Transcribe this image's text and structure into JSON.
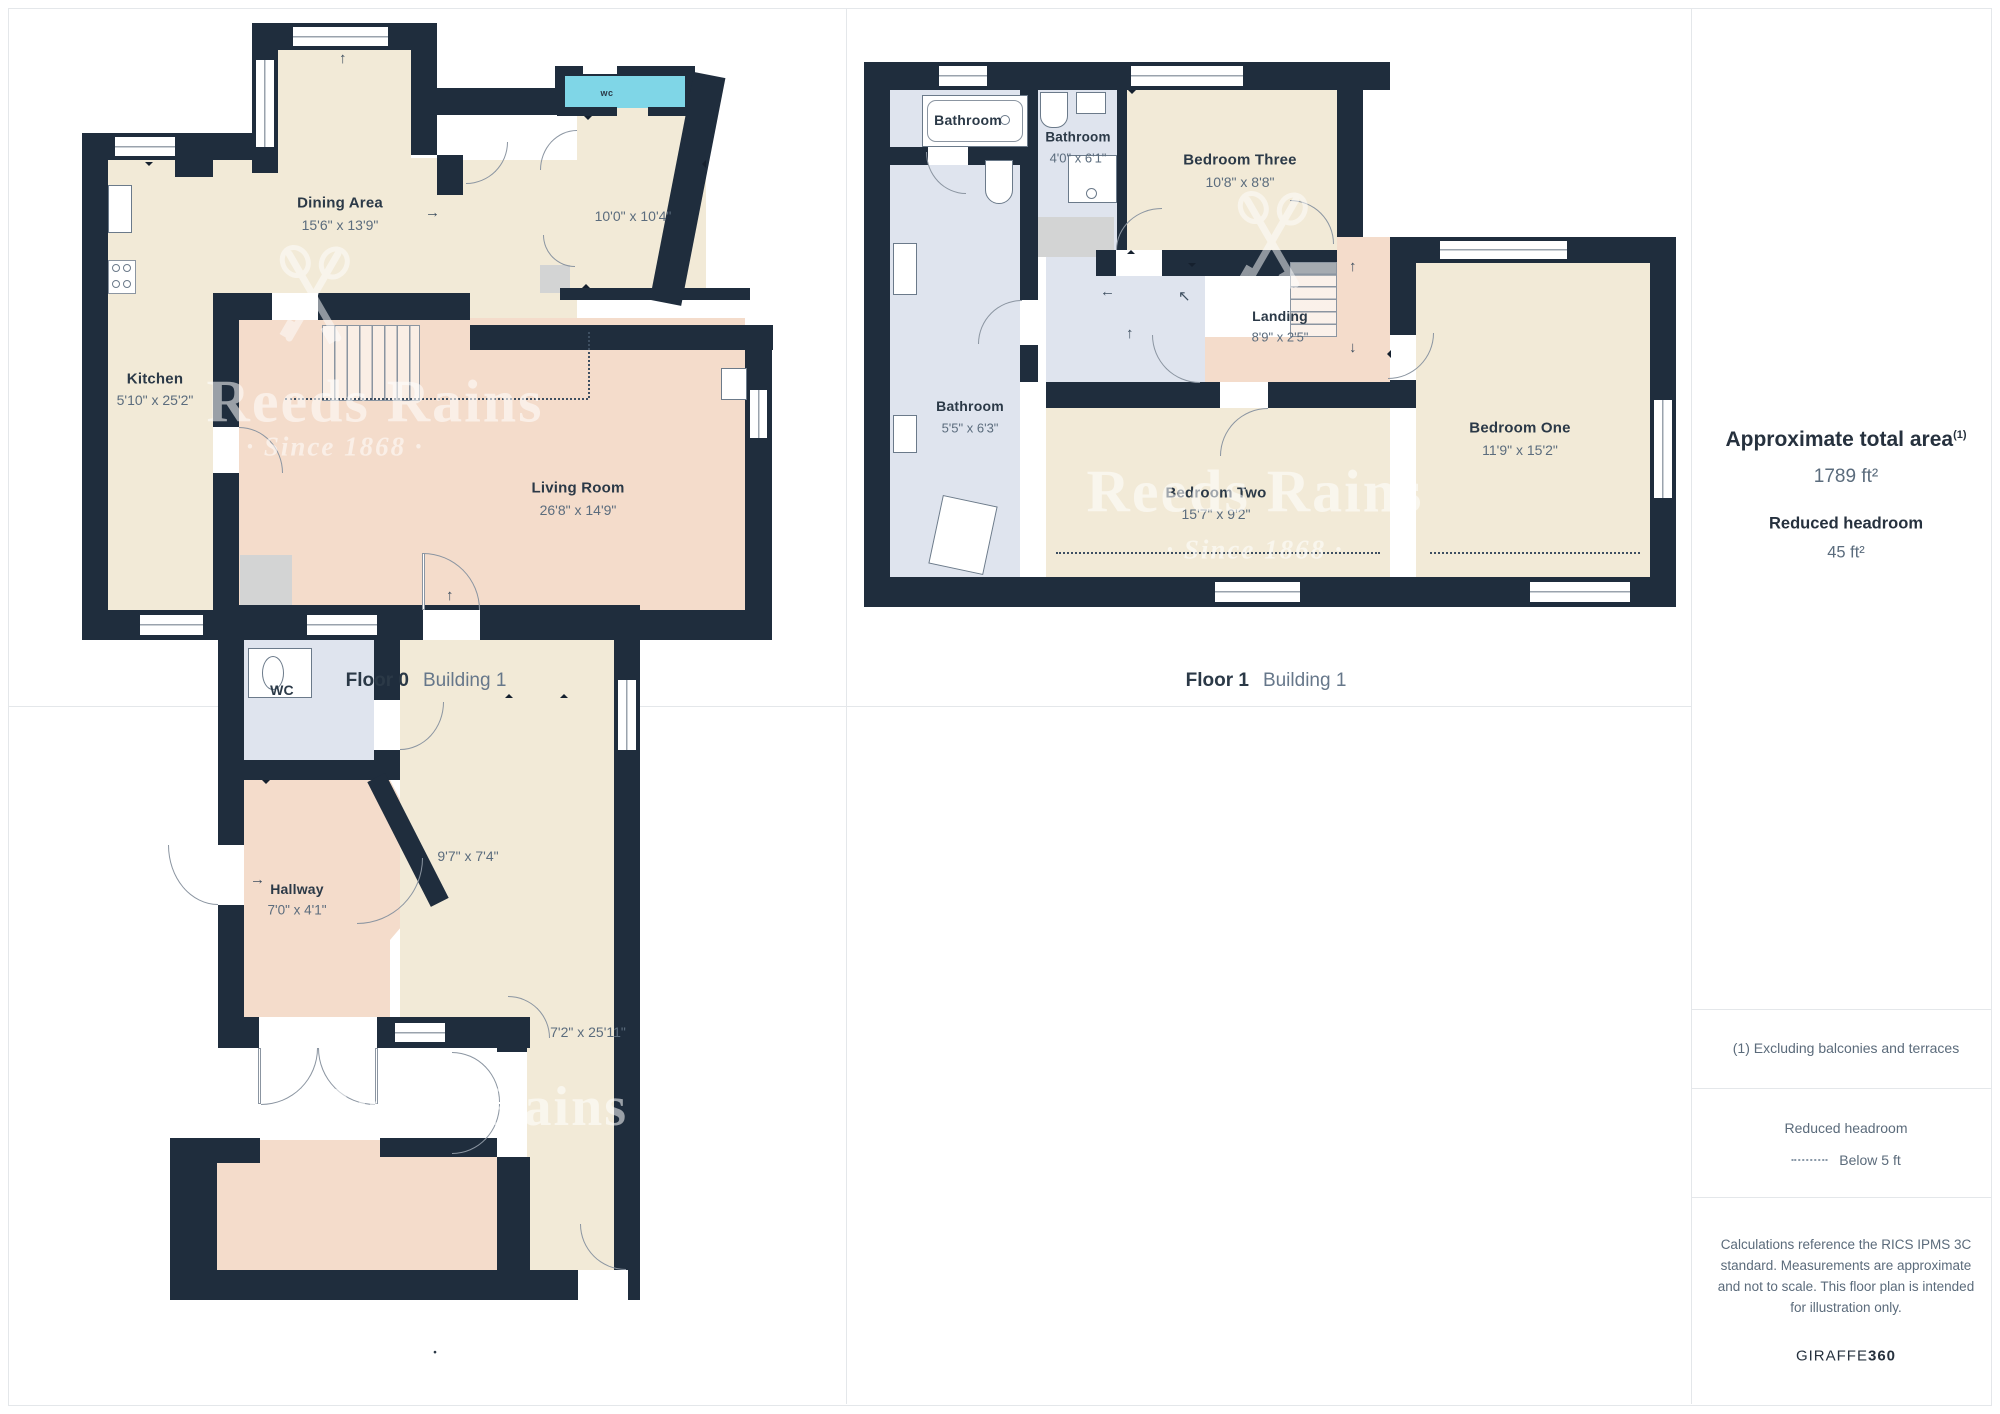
{
  "watermark": {
    "brand": "Reeds Rains",
    "tagline": "· Since 1868 ·"
  },
  "floor0": {
    "caption": {
      "floor": "Floor 0",
      "building": "Building 1"
    },
    "labels": {
      "dining": {
        "name": "Dining Area",
        "dims": "15'6\" x 13'9\""
      },
      "room10": {
        "dims": "10'0\" x 10'4\""
      },
      "kitchen": {
        "name": "Kitchen",
        "dims": "5'10\" x 25'2\""
      },
      "living": {
        "name": "Living Room",
        "dims": "26'8\" x 14'9\""
      },
      "wc": "wc"
    }
  },
  "floor1": {
    "caption": {
      "floor": "Floor 1",
      "building": "Building 1"
    },
    "labels": {
      "bath_top": "Bathroom",
      "bath_small": {
        "name": "Bathroom",
        "dims": "4'0\" x 6'1\""
      },
      "bath_left": {
        "name": "Bathroom",
        "dims": "5'5\" x 6'3\""
      },
      "bed3": {
        "name": "Bedroom Three",
        "dims": "10'8\" x 8'8\""
      },
      "landing": {
        "name": "Landing",
        "dims": "8'9\" x 2'5\""
      },
      "bed2": {
        "name": "Bedroom Two",
        "dims": "15'7\" x 9'2\""
      },
      "bed1": {
        "name": "Bedroom One",
        "dims": "11'9\" x 15'2\""
      }
    }
  },
  "floorB": {
    "caption_dot": "•",
    "labels": {
      "wc": "WC",
      "hallway": {
        "name": "Hallway",
        "dims": "7'0\" x 4'1\""
      },
      "room97": {
        "dims": "9'7\" x 7'4\""
      },
      "corridor": {
        "dims": "7'2\" x 25'11\""
      }
    }
  },
  "sidebar": {
    "area_title": "Approximate total area",
    "area_sup": "(1)",
    "area_value": "1789 ft²",
    "rh_title": "Reduced headroom",
    "rh_value": "45 ft²",
    "note": "(1) Excluding balconies and terraces",
    "legend_title": "Reduced headroom",
    "legend_item": "Below 5 ft",
    "disclaimer": "Calculations reference the RICS IPMS 3C standard. Measurements are approximate and not to scale. This floor plan is intended for illustration only.",
    "brand_name": "GIRAFFE",
    "brand_bold": "360"
  },
  "colors": {
    "wall": "#1f2d3d",
    "beige": "#f2ead7",
    "pink": "#f4dccb",
    "bath_blue": "#dfe4ee",
    "wc_cyan": "#7fd6e7",
    "accent_gray": "#d3d4d4"
  }
}
